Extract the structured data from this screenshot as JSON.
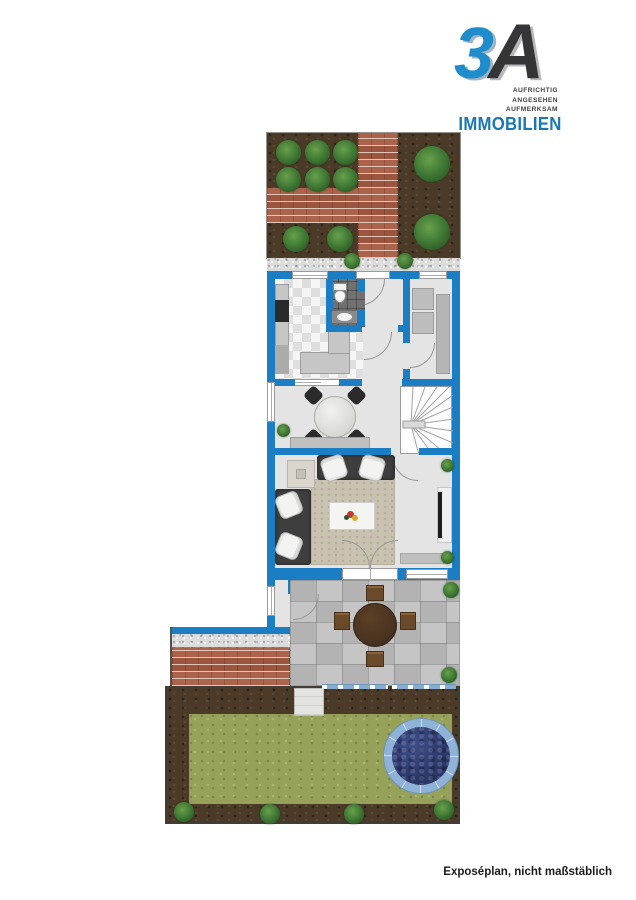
{
  "logo": {
    "mark": {
      "three": "3",
      "a": "A"
    },
    "tagline_lines": [
      "AUFRICHTIG",
      "ANGESEHEN",
      "AUFMERKSAM"
    ],
    "brand": "IMMOBILIEN"
  },
  "footer": {
    "note": "Exposéplan, nicht maßstäblich"
  },
  "palette": {
    "wall_blue": "#1b7ec5",
    "floor": "#e4e4e4",
    "bath_tile": "#717171",
    "brick": "#a85b43",
    "soil": "#4b3a28",
    "lawn": "#96a15a",
    "gravel": "#dcdcdc",
    "paver": "#bdbdbd",
    "rug": "#c9c2b0",
    "pool_water": "#2e3a6e",
    "pool_rim": "#8fb3d8",
    "wood_dark": "#4a3320",
    "logo_blue": "#1f8dcb",
    "logo_dark": "#353537",
    "brand_blue": "#1878b6"
  }
}
